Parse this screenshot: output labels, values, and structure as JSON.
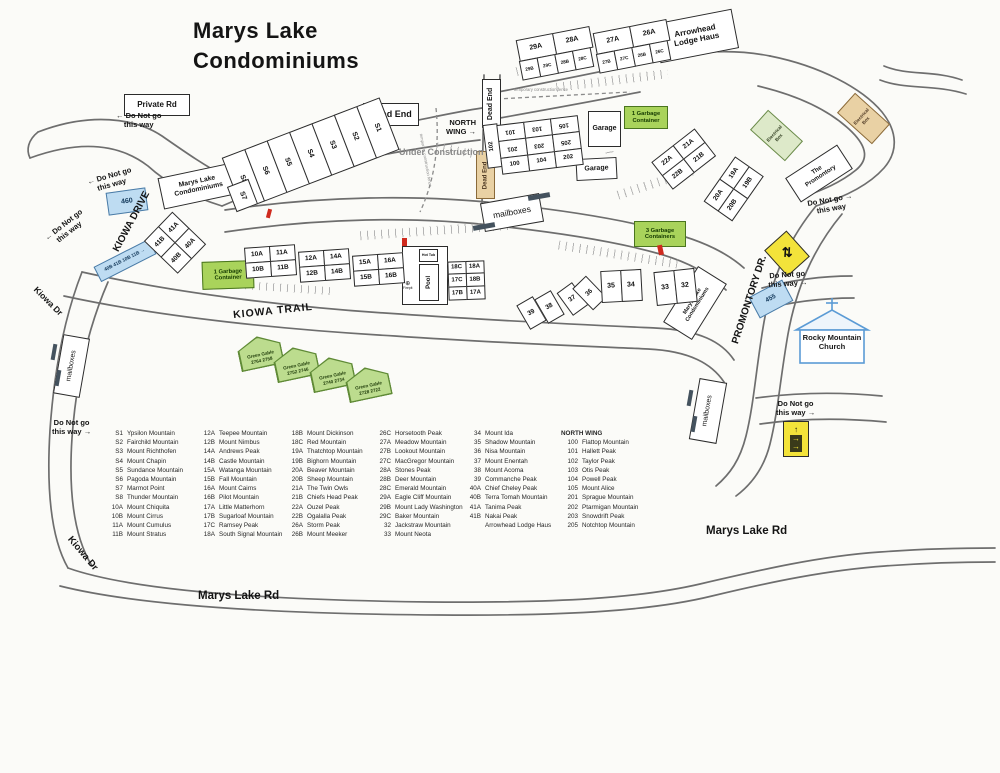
{
  "title": {
    "line1": "Marys Lake",
    "line2": "Condominiums"
  },
  "colors": {
    "garbage_green": "#a9d35b",
    "pale_green": "#dde9c9",
    "sign_blue": "#bedcf2",
    "sign_yellow": "#f3e33a",
    "sign_tan": "#e9d1a4",
    "hydrant_red": "#cf2a1e",
    "church_blue": "#5b9bd5",
    "ink": "#2b2b2b",
    "road_gray": "#6e6e6e"
  },
  "road_labels": {
    "kiowa_drive": "KIOWA DRIVE",
    "kiowa_dr": "Kiowa Dr",
    "kiowa_trail": "KIOWA TRAIL",
    "promontory_dr": "PROMONTORY DR.",
    "marys_lake_rd": "Marys Lake Rd",
    "private_rd": "Private Rd"
  },
  "signs": {
    "dead_end": "Dead End",
    "north_wing_line1": "NORTH",
    "north_wing_line2": "WING →",
    "under_construction": "Under Construction",
    "temp_fence": "temporary construction fence",
    "do_not_go_line1": "Do Not go",
    "do_not_go_line2": "this way",
    "arrow_left": "←",
    "arrow_right": "→",
    "arrow_up": "↑",
    "crossing_icon": "⇅",
    "condo_sign_line1": "Marys Lake",
    "condo_sign_line2": "Condominiums",
    "arrowhead_line1": "Arrowhead",
    "arrowhead_line2": "Lodge Haus",
    "promontory_line1": "The",
    "promontory_line2": "Promontory",
    "church_line1": "Rocky Mountain",
    "church_line2": "Church",
    "garage": "Garage",
    "garbage_1_line1": "1 Garbage",
    "garbage_1_line2": "Container",
    "garbage_3_line1": "3 Garbage",
    "garbage_3_line2": "Containers",
    "electrical_line1": "Electrical",
    "electrical_line2": "Box",
    "mailboxes": "mailboxes",
    "pool": "Pool",
    "hot_tub": "Hot Tub",
    "firepit": "Firepit",
    "firepit_icon": "⊕",
    "sign_460": "460",
    "sign_455": "455",
    "unit_sign": "40B 41B 10B 11B →"
  },
  "buildings": {
    "s_row": [
      "S8",
      "S6",
      "S5",
      "S4",
      "S3",
      "S2",
      "S1"
    ],
    "s7": "S7",
    "b2928_top": [
      [
        "29A",
        "28A"
      ]
    ],
    "b2928_sub": [
      [
        "29B",
        "29C",
        "28B",
        "28C"
      ]
    ],
    "b2726_top": [
      [
        "27A",
        "26A"
      ]
    ],
    "b2726_sub": [
      [
        "27B",
        "27C",
        "26B",
        "26C"
      ]
    ],
    "north_wing_side": "102",
    "north_wing_rows": [
      [
        "101",
        "103",
        "105"
      ],
      [
        "201",
        "203",
        "205"
      ],
      [
        "100",
        "104",
        "202"
      ]
    ],
    "b2221": [
      [
        "22A",
        "21A"
      ],
      [
        "22B",
        "21B"
      ]
    ],
    "b2019": [
      [
        "20A",
        "19A"
      ],
      [
        "20B",
        "19B"
      ]
    ],
    "b1011": [
      [
        "10A",
        "11A"
      ],
      [
        "10B",
        "11B"
      ]
    ],
    "b1214": [
      [
        "12A",
        "14A"
      ],
      [
        "12B",
        "14B"
      ]
    ],
    "b1516": [
      [
        "15A",
        "16A"
      ],
      [
        "15B",
        "16B"
      ]
    ],
    "b1718": [
      [
        "18C",
        "18A"
      ],
      [
        "17C",
        "18B"
      ],
      [
        "17B",
        "17A"
      ]
    ],
    "b4140": [
      [
        "41A",
        "40A"
      ],
      [
        "41B",
        "40B"
      ]
    ],
    "b39": "39",
    "b38": "38",
    "b37": "37",
    "b36": "36",
    "b3534": [
      [
        "35",
        "34"
      ]
    ],
    "b3332": [
      [
        "33",
        "32"
      ]
    ]
  },
  "green_gables": {
    "label": "Green Gable",
    "numbers": [
      "2764 2758",
      "2752 2746",
      "2740 2734",
      "2728 2722"
    ]
  },
  "legend": {
    "columns": [
      {
        "header": null,
        "items": [
          {
            "id": "S1",
            "name": "Ypsilon Mountain"
          },
          {
            "id": "S2",
            "name": "Fairchild Mountain"
          },
          {
            "id": "S3",
            "name": "Mount Richthofen"
          },
          {
            "id": "S4",
            "name": "Mount Chapin"
          },
          {
            "id": "S5",
            "name": "Sundance Mountain"
          },
          {
            "id": "S6",
            "name": "Pagoda Mountain"
          },
          {
            "id": "S7",
            "name": "Marmot Point"
          },
          {
            "id": "S8",
            "name": "Thunder Mountain"
          },
          {
            "id": "10A",
            "name": "Mount Chiquita"
          },
          {
            "id": "10B",
            "name": "Mount Cirrus"
          },
          {
            "id": "11A",
            "name": "Mount Cumulus"
          },
          {
            "id": "11B",
            "name": "Mount Stratus"
          }
        ]
      },
      {
        "header": null,
        "items": [
          {
            "id": "12A",
            "name": "Teepee Mountain"
          },
          {
            "id": "12B",
            "name": "Mount Nimbus"
          },
          {
            "id": "14A",
            "name": "Andrews Peak"
          },
          {
            "id": "14B",
            "name": "Castle Mountain"
          },
          {
            "id": "15A",
            "name": "Watanga Mountain"
          },
          {
            "id": "15B",
            "name": "Fall Mountain"
          },
          {
            "id": "16A",
            "name": "Mount Cairns"
          },
          {
            "id": "16B",
            "name": "Pilot Mountain"
          },
          {
            "id": "17A",
            "name": "Little Matterhorn"
          },
          {
            "id": "17B",
            "name": "Sugarloaf Mountain"
          },
          {
            "id": "17C",
            "name": "Ramsey Peak"
          },
          {
            "id": "18A",
            "name": "South Signal Mountain"
          }
        ]
      },
      {
        "header": null,
        "items": [
          {
            "id": "18B",
            "name": "Mount Dickinson"
          },
          {
            "id": "18C",
            "name": "Red Mountain"
          },
          {
            "id": "19A",
            "name": "Thatchtop Mountain"
          },
          {
            "id": "19B",
            "name": "Bighorn Mountain"
          },
          {
            "id": "20A",
            "name": "Beaver Mountain"
          },
          {
            "id": "20B",
            "name": "Sheep Mountain"
          },
          {
            "id": "21A",
            "name": "The Twin Owls"
          },
          {
            "id": "21B",
            "name": "Chiefs Head Peak"
          },
          {
            "id": "22A",
            "name": "Ouzel Peak"
          },
          {
            "id": "22B",
            "name": "Ogalalla Peak"
          },
          {
            "id": "26A",
            "name": "Storm Peak"
          },
          {
            "id": "26B",
            "name": "Mount Meeker"
          }
        ]
      },
      {
        "header": null,
        "items": [
          {
            "id": "26C",
            "name": "Horsetooth Peak"
          },
          {
            "id": "27A",
            "name": "Meadow Mountain"
          },
          {
            "id": "27B",
            "name": "Lookout Mountain"
          },
          {
            "id": "27C",
            "name": "MacGregor Mountain"
          },
          {
            "id": "28A",
            "name": "Stones Peak"
          },
          {
            "id": "28B",
            "name": "Deer Mountain"
          },
          {
            "id": "28C",
            "name": "Emerald Mountain"
          },
          {
            "id": "29A",
            "name": "Eagle Cliff Mountain"
          },
          {
            "id": "29B",
            "name": "Mount Lady Washington"
          },
          {
            "id": "29C",
            "name": "Baker Mountain"
          },
          {
            "id": "32",
            "name": "Jackstraw Mountain"
          },
          {
            "id": "33",
            "name": "Mount Neota"
          }
        ]
      },
      {
        "header": null,
        "items": [
          {
            "id": "34",
            "name": "Mount Ida"
          },
          {
            "id": "35",
            "name": "Shadow Mountain"
          },
          {
            "id": "36",
            "name": "Nisa Mountain"
          },
          {
            "id": "37",
            "name": "Mount Enentah"
          },
          {
            "id": "38",
            "name": "Mount Acoma"
          },
          {
            "id": "39",
            "name": "Commanche Peak"
          },
          {
            "id": "40A",
            "name": "Chief Cheley Peak"
          },
          {
            "id": "40B",
            "name": "Terra Tomah Mountain"
          },
          {
            "id": "41A",
            "name": "Tanima Peak"
          },
          {
            "id": "41B",
            "name": "Nakai Peak"
          },
          {
            "id": "",
            "name": "Arrowhead Lodge Haus"
          }
        ]
      },
      {
        "header": "NORTH WING",
        "items": [
          {
            "id": "100",
            "name": "Flattop Mountain"
          },
          {
            "id": "101",
            "name": "Hallett Peak"
          },
          {
            "id": "102",
            "name": "Taylor Peak"
          },
          {
            "id": "103",
            "name": "Otis Peak"
          },
          {
            "id": "104",
            "name": "Powell Peak"
          },
          {
            "id": "105",
            "name": "Mount Alice"
          },
          {
            "id": "201",
            "name": "Sprague Mountain"
          },
          {
            "id": "202",
            "name": "Ptarmigan Mountain"
          },
          {
            "id": "203",
            "name": "Snowdrift Peak"
          },
          {
            "id": "205",
            "name": "Notchtop Mountain"
          }
        ]
      }
    ]
  }
}
